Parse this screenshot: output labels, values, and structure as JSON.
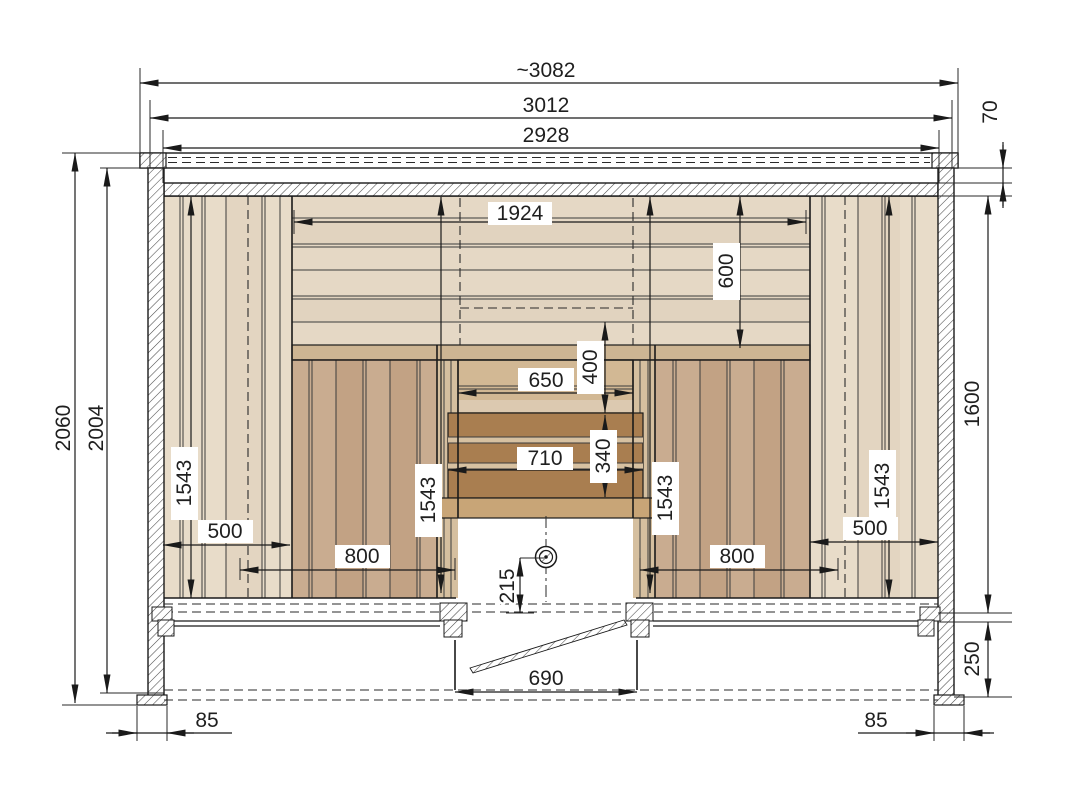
{
  "drawing": {
    "type": "technical-elevation",
    "subject": "sauna-front-elevation",
    "dimensions": {
      "top": {
        "overall_width": "~3082",
        "outer_width": "3012",
        "inner_width": "2928"
      },
      "left": {
        "total_height": "2060",
        "wall_height": "2004"
      },
      "right": {
        "roof_gap": "70",
        "interior_height": "1600",
        "plinth_height": "250"
      },
      "interior": {
        "backrest_width": "1924",
        "backrest_height": "600",
        "recess_upper_width": "650",
        "recess_upper_height": "400",
        "recess_lower_width": "710",
        "recess_lower_height": "340",
        "panel_height_left_outer": "1543",
        "panel_height_left_inner": "1543",
        "panel_height_right_inner": "1543",
        "panel_height_right_outer": "1543",
        "side_panel_width_left": "500",
        "side_panel_width_right": "500",
        "bench_width_left": "800",
        "bench_width_right": "800",
        "sensor_height": "215"
      },
      "bottom": {
        "door_width": "690",
        "foot_width_left": "85",
        "foot_width_right": "85"
      }
    },
    "colors": {
      "plank_light": "#e8dcc9",
      "plank_light_alt": "#e3d5c1",
      "backrest": "#e5d8c5",
      "backrest_alt": "#e1d3bf",
      "bench_front": "#c9ac90",
      "bench_front_alt": "#c2a284",
      "door_post": "#d5bf9f",
      "stack_upper": "#d2b894",
      "stack_dark": "#a97e50",
      "stack_gap": "#d7c1a1",
      "stack_band": "#c8a577",
      "rail": "#cdb593",
      "line": "#1a1a1a"
    }
  }
}
